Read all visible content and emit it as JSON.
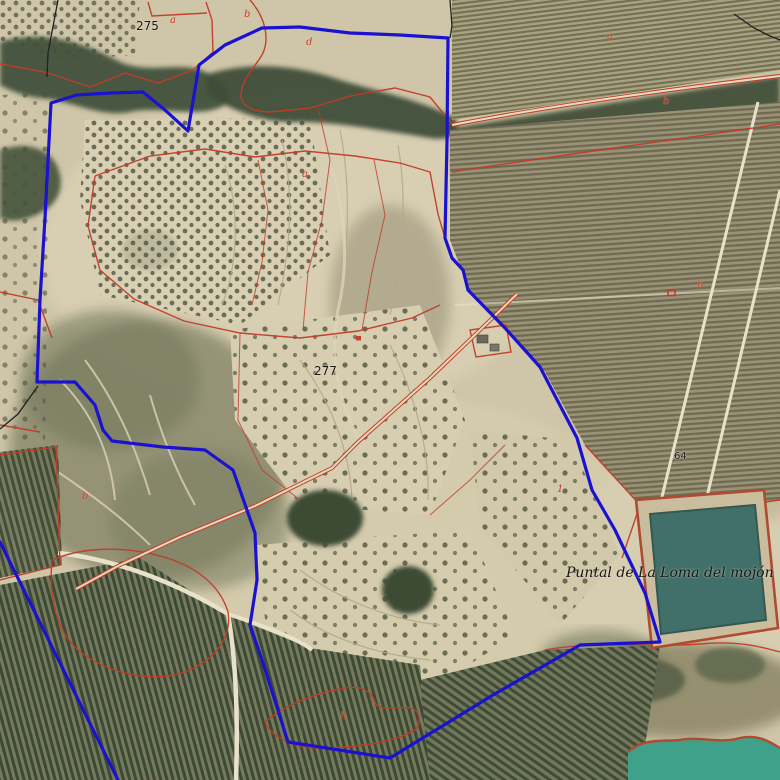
{
  "map": {
    "type": "cadastral-parcel-orthophoto",
    "place_name": "Puntal  de La Loma del mojón"
  },
  "colors": {
    "parcel_boundary_blue": "#1a12cf",
    "cadastral_red": "#c23b27",
    "road_salmon": "#d98a72",
    "reservoir_water": "#41706a",
    "pond_water": "#3fa189",
    "terrain_tan": "#cfc5a8",
    "forest_green": "#41503a",
    "label_black": "#161616"
  },
  "labels": [
    {
      "id": "spot-height-275",
      "text": "275",
      "x": 136,
      "y": 20,
      "kind": "elevation",
      "size": 12
    },
    {
      "id": "spot-height-277",
      "text": "277",
      "x": 314,
      "y": 365,
      "kind": "elevation",
      "size": 12
    },
    {
      "id": "spot-height-64",
      "text": "64",
      "x": 674,
      "y": 452,
      "kind": "elevation",
      "size": 10
    },
    {
      "id": "place-name",
      "text": "Puntal  de La Loma del mojón",
      "x": 566,
      "y": 566,
      "kind": "place",
      "size": 14
    },
    {
      "id": "subparcel-a1",
      "text": "a",
      "x": 170,
      "y": 16,
      "kind": "subparcel",
      "size": 10
    },
    {
      "id": "subparcel-b1",
      "text": "b",
      "x": 244,
      "y": 10,
      "kind": "subparcel",
      "size": 10
    },
    {
      "id": "subparcel-d1",
      "text": "d",
      "x": 306,
      "y": 38,
      "kind": "subparcel",
      "size": 10
    },
    {
      "id": "subparcel-a2",
      "text": "a",
      "x": 302,
      "y": 170,
      "kind": "subparcel",
      "size": 10
    },
    {
      "id": "subparcel-b2",
      "text": "b",
      "x": 82,
      "y": 492,
      "kind": "subparcel",
      "size": 10
    },
    {
      "id": "subparcel-h1",
      "text": "h",
      "x": 340,
      "y": 712,
      "kind": "subparcel",
      "size": 10
    },
    {
      "id": "subparcel-a3",
      "text": "a",
      "x": 607,
      "y": 32,
      "kind": "subparcel",
      "size": 10
    },
    {
      "id": "subparcel-b3",
      "text": "b",
      "x": 663,
      "y": 97,
      "kind": "subparcel",
      "size": 10
    },
    {
      "id": "subparcel-1",
      "text": "1",
      "x": 557,
      "y": 485,
      "kind": "subparcel",
      "size": 10
    },
    {
      "id": "subparcel-b4",
      "text": "b",
      "x": 697,
      "y": 281,
      "kind": "subparcel",
      "size": 10
    }
  ]
}
